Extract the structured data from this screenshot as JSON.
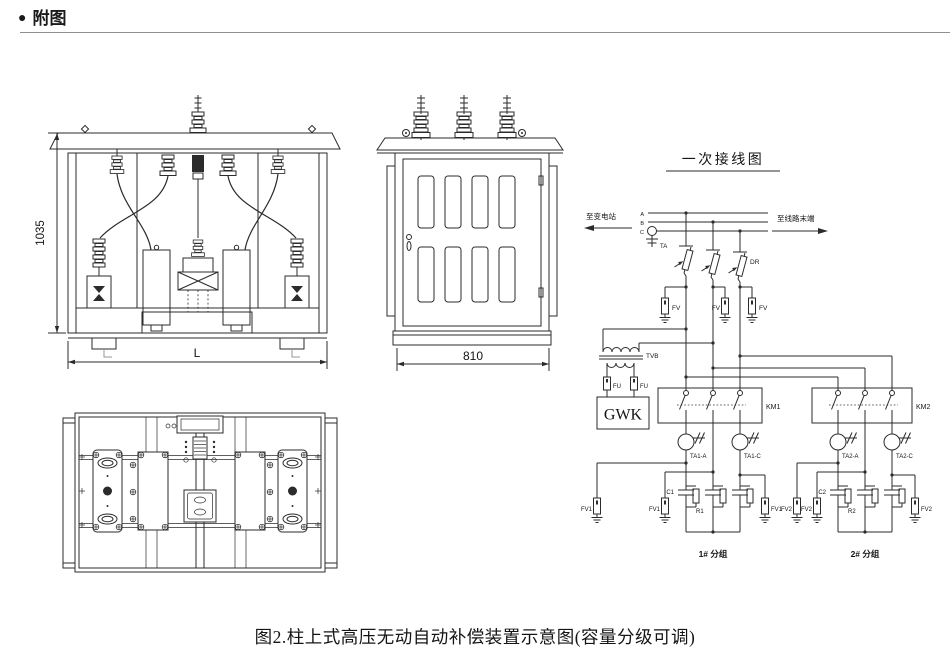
{
  "header": {
    "bullet": "●",
    "title": "附图"
  },
  "caption": "图2.柱上式高压无动自动补偿装置示意图(容量分级可调)",
  "front_view": {
    "height_dim": "1035",
    "width_dim": "L"
  },
  "side_view": {
    "width_dim": "810"
  },
  "schematic": {
    "title": "一次接线图",
    "left_label": "至变电站",
    "right_label": "至线路末端",
    "phases": [
      "A",
      "B",
      "C"
    ],
    "ta": "TA",
    "dr": "DR",
    "fv": "FV",
    "tvb": "TVB",
    "fu": "FU",
    "controller": "GWK",
    "km1": "KM1",
    "km2": "KM2",
    "ta1a": "TA1-A",
    "ta1c": "TA1-C",
    "ta2a": "TA2-A",
    "ta2c": "TA2-C",
    "c1": "C1",
    "r1": "R1",
    "c2": "C2",
    "r2": "R2",
    "fv1": "FV1",
    "fv2": "FV2",
    "group1": "1# 分组",
    "group2": "2# 分组"
  }
}
